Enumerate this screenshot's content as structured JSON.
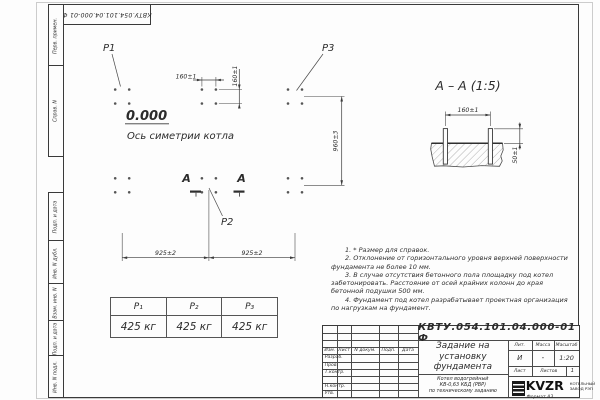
{
  "sheet": {
    "doc_number": "КВТУ.054.101.04.000-01 Ф",
    "format_label": "Формат А3"
  },
  "margin_stamps": {
    "items": [
      "Перв. примен.",
      "Справ. N",
      "Подп. и дата",
      "Инв. N дубл.",
      "Взам. инв. N",
      "Подп. и дата",
      "Инв. N подл."
    ]
  },
  "plan": {
    "p1": "P1",
    "p2": "P2",
    "p3": "P3",
    "elevation": "0.000",
    "axis_label": "Ось симетрии котла",
    "section_letter": "А",
    "dim_bolt_h": "160±1",
    "dim_bolt_v": "160±1",
    "dim_rows": "960±3",
    "dim_col_left": "925±2",
    "dim_col_right": "925±2"
  },
  "section": {
    "title": "А – А (1:5)",
    "dim_spacing": "160±1",
    "dim_height": "50±1"
  },
  "notes": [
    "1. * Размер для справок.",
    "2. Отклонение от горизонтального уровня верхней поверхности фундамента не более 10 мм.",
    "3. В случае отсутствия бетонного пола площадку под котел забетонировать. Расстояние от осей крайних колонн до края бетонной подушки 500 мм.",
    "4. Фундамент под котел разрабатывает проектная организация по нагрузкам на фундамент."
  ],
  "load_table": {
    "headers": [
      "P₁",
      "P₂",
      "P₃"
    ],
    "values": [
      "425 кг",
      "425 кг",
      "425 кг"
    ]
  },
  "title_block": {
    "col_izm": "Изм.",
    "col_list": "Лист",
    "col_ndok": "N докум.",
    "col_podp": "Подп.",
    "col_data": "Дата",
    "row_razrab": "Разраб.",
    "row_prov": "Пров.",
    "row_tkontr": "Т.контр.",
    "row_nkontr": "Н.контр.",
    "row_utv": "Утв.",
    "title_lines": [
      "Задание на",
      "установку",
      "фундамента"
    ],
    "subtitle_lines": [
      "Котел водогрейный",
      "КВ-0,63 КБД (РВР)",
      "по техническому заданию"
    ],
    "lit_label": "Лит.",
    "mass_label": "Масса",
    "scale_label": "Масштаб",
    "lit_value": "И",
    "mass_value": "-",
    "scale_value": "1:20",
    "list_label": "Лист",
    "listov_label": "Листов",
    "listov_value": "1",
    "logo_text": "KVZR",
    "company_line1": "КОТЕЛЬНЫЙ",
    "company_line2": "ЗАВОД РЭП"
  }
}
